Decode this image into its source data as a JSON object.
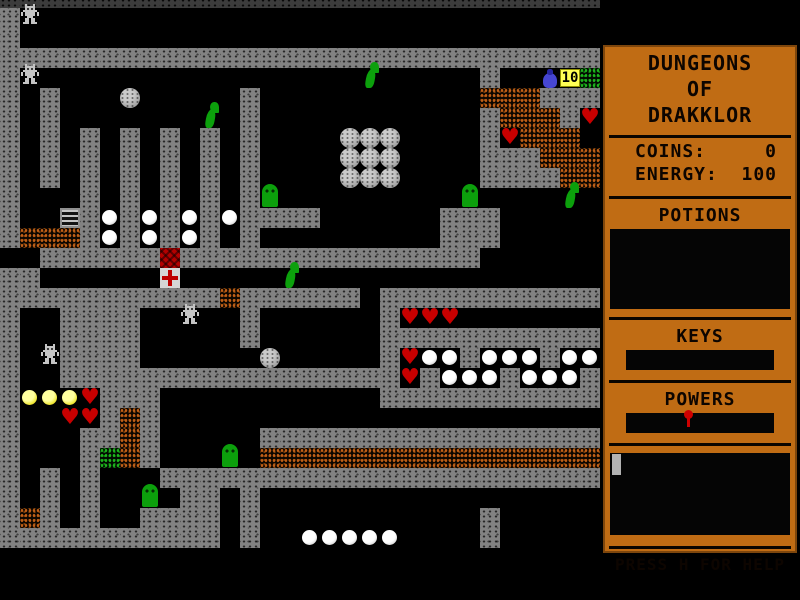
{
  "sidebar": {
    "title_lines": [
      "DUNGEONS",
      "OF",
      "DRAKKLOR"
    ],
    "stats": [
      {
        "label": "COINS:",
        "value": "0"
      },
      {
        "label": "ENERGY:",
        "value": "100"
      }
    ],
    "sections": {
      "potions": "POTIONS",
      "keys": "KEYS",
      "powers": "POWERS"
    },
    "help": "PRESS H FOR HELP",
    "colors": {
      "panel": "#C06C14",
      "text": "#0D0500",
      "inventory_box": "#050505",
      "power_pin": "#CE0000",
      "message_cursor": "#B2B2B2"
    }
  },
  "map": {
    "tile_size": 20,
    "cols": 30,
    "rows_count": 28,
    "colors": {
      "wall": "#828282",
      "dark_wall": "#3C3C3C",
      "dirt": "#C06018",
      "green_rubble": "#1EB41E",
      "monster_green": "#0CA00C",
      "heart": "#C80000",
      "gold": "#F0E838",
      "coin_tag_bg": "#FFFF55",
      "potion_blue": "#4646D2"
    },
    "legend": {
      "#": {
        "cls": "t-wall",
        "name": "wall-tile"
      },
      "D": {
        "cls": "t-dwall",
        "name": "dark-wall-tile"
      },
      "d": {
        "cls": "t-dirt",
        "name": "dirt-rubble-tile"
      },
      "g": {
        "cls": "t-green",
        "name": "green-rubble-tile"
      },
      "L": {
        "cls": "t-ladder",
        "name": "ladder-tile"
      },
      "r": {
        "cls": "t-red",
        "name": "red-brick-tile"
      },
      "c": {
        "cls": "t-cross",
        "name": "cross-tile"
      },
      "o": {
        "cls": "t-ball",
        "name": "white-ball-item"
      },
      "y": {
        "cls": "t-gold",
        "name": "gold-ball-item"
      },
      "h": {
        "cls": "t-heart",
        "name": "heart-item"
      },
      "B": {
        "cls": "t-boulder",
        "name": "boulder"
      },
      "S": {
        "cls": "t-slime",
        "name": "slime-monster"
      },
      "W": {
        "cls": "t-worm",
        "name": "worm-monster"
      },
      "R": {
        "cls": "t-golem",
        "name": "golem-sprite"
      },
      "P": {
        "cls": "t-potion",
        "name": "potion-item"
      },
      "T": {
        "cls": "t-tag",
        "name": "coin-counter-tag",
        "text": "10"
      }
    },
    "rows": [
      "DDDDDDDDDDDDDDDDDDDDDDDDDDDDDD",
      "#R............................",
      "#.............................",
      "##############################",
      "#R................W.....#..PTg",
      "#.#...B.....#...........ddd###",
      "#.#.......W.#...........#ddd#h",
      "#.#.#.#.#.#.#....BBB....#hddd.",
      "#.#.#.#.#.#.#....BBB....###ddd",
      "#.#.#.#.#.#.#....BBB....####dd",
      "#...#.#.#.#.#S.........S....W.",
      "#..L#o#o#o#o####......###.....",
      "#ddd#o#o#o#.#.........###.....",
      "..######r###############......",
      "##......c.....W...............",
      "###########d######.###########",
      "#..####..R..#......#hhh.......",
      "#..####.....#......###########",
      "#.R####......B.....#hoo#ooo#oo",
      "#..#################h#ooo#ooo#",
      "#yyyh###...........###########",
      "#..hh#d#......................",
      "#...##d#.....#################",
      "#...#gd#...S.ddddddddddddddddd",
      "#.#.#...######################",
      "#.#.#..S.##.#.................",
      "#d#.#..####.#...........#.....",
      "###########.#..ooooo....#....."
    ]
  }
}
